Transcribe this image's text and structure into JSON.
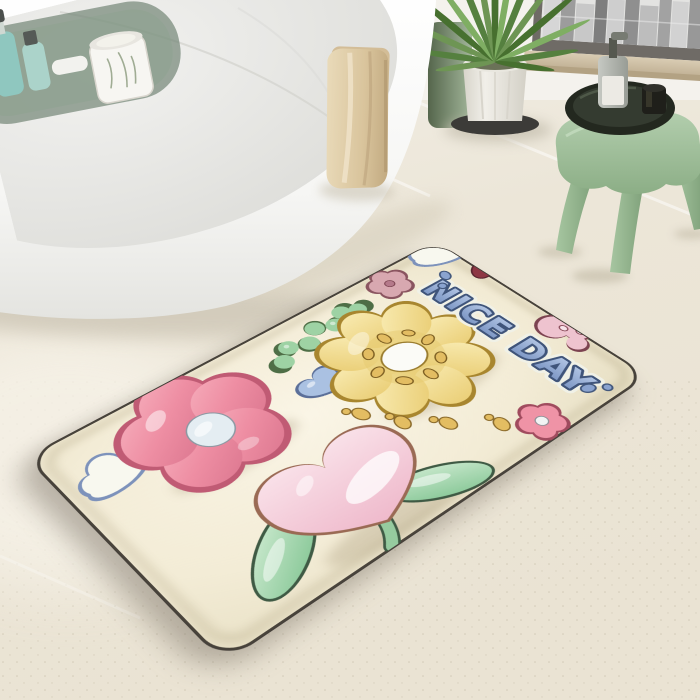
{
  "meta": {
    "description": "Bathroom product photo: cream 3D-puffy flower bath mat beside a white freestanding bathtub, potted areca palm, city-view window and sage green stool with toiletries"
  },
  "mat": {
    "product": "3D inflated-effect flower bath mat",
    "text": "NICE DAY",
    "accent_dots": 4,
    "base_color": "#f3ecd6",
    "outline_color": "#46413a",
    "elements": [
      "blue-outline-cloud",
      "pink-flower",
      "green-leaf-sprig",
      "dusty-pink-flower",
      "corner-cloud",
      "blue-heart",
      "yellow-flower",
      "gold-seed-dots",
      "pink-heart-tulip",
      "tulip-stem",
      "tulip-leaves",
      "nice-day-text",
      "small-pink-flower",
      "pink-corner-blob",
      "red-edge-blob"
    ],
    "colors": {
      "flower_pink": "#ee8ea3",
      "flower_pink_outline": "#c05b74",
      "flower_center_blue": "#e4edf2",
      "yellow": "#f0d88a",
      "yellow_outline": "#a8862f",
      "green_leaf": "#9ed2a4",
      "green_dark": "#46634c",
      "heart_blue": "#aac1e2",
      "cloud_blue": "#7d92bb",
      "cloud_white": "#f8f8ef",
      "tulip_pink": "#f2c6d2",
      "tulip_outline": "#9a6a54",
      "dusty_pink": "#d8a8b0",
      "flower_small_pink": "#ef93a6",
      "seed_gold": "#e3bd62",
      "text_blue": "#7d9bca",
      "text_outline": "#3f547a",
      "red_blob": "#8e3744",
      "blob_pink": "#eec3cf"
    }
  },
  "bathtub": {
    "type": "white freestanding tub",
    "color": "#fbfbf9",
    "caddy_items": [
      "teal-pump-bottle",
      "teal-bottle",
      "soap-bar",
      "candle-jar"
    ],
    "candle_color": "#f7f6f2"
  },
  "towel": {
    "color": "#dcc7a0",
    "flap_color": "#d3bd97"
  },
  "plant": {
    "type": "areca palm",
    "pot_color": "#ece9e2",
    "leaf_color": "#6d9454"
  },
  "stool": {
    "type": "sculpted three-leg stool",
    "color": "#a3c49e",
    "items": [
      "round-tray",
      "pump-bottle",
      "black-cup"
    ],
    "tray_color": "#343b30",
    "bottle_label_color": "#eceae4"
  },
  "window": {
    "frame_color": "#6f6b66",
    "view": "city skyline",
    "sill_color": "#cfc0a6"
  },
  "floor": {
    "color": "#eae3d4",
    "tile": "large format with white grout"
  }
}
